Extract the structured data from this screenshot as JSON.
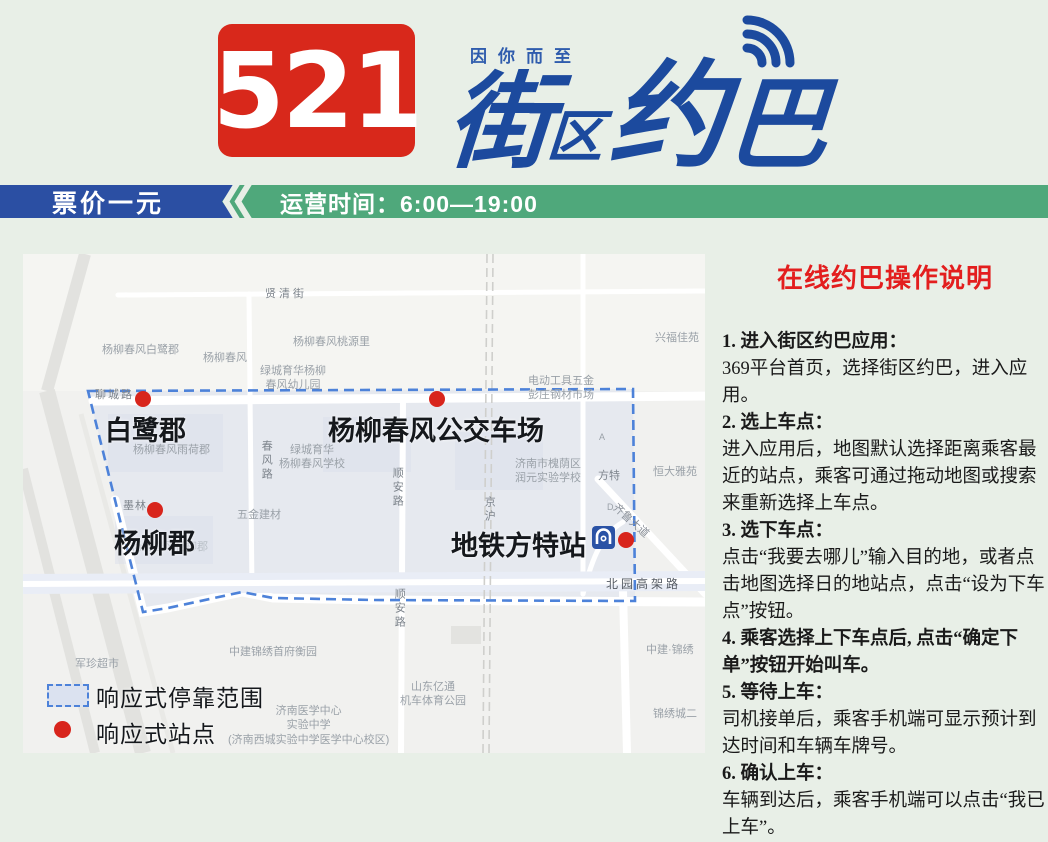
{
  "header": {
    "route_number": "521",
    "slogan": "因你而至",
    "brand_chars": {
      "c1": "街",
      "c2": "区",
      "c3": "约",
      "c4": "巴"
    },
    "colors": {
      "route_box": "#d8281b",
      "brand_blue": "#1c4a9e"
    }
  },
  "banner": {
    "fare": "票价一元",
    "hours": "运营时间：6:00—19:00",
    "colors": {
      "blue": "#2b4fa3",
      "green": "#4fa87b"
    }
  },
  "map": {
    "stations": [
      {
        "name": "白鹭郡",
        "dot_x": 120,
        "dot_y": 145,
        "label_x": 82,
        "label_y": 155
      },
      {
        "name": "杨柳春风公交车场",
        "dot_x": 414,
        "dot_y": 145,
        "label_x": 305,
        "label_y": 155
      },
      {
        "name": "杨柳郡",
        "dot_x": 132,
        "dot_y": 256,
        "label_x": 91,
        "label_y": 268
      },
      {
        "name": "地铁方特站",
        "dot_x": 603,
        "dot_y": 286,
        "label_x": 428,
        "label_y": 270
      }
    ],
    "legend": [
      {
        "label": "响应式停靠范围"
      },
      {
        "label": "响应式站点"
      }
    ],
    "labels": [
      {
        "t": "贤清街",
        "x": 242,
        "y": 33,
        "c": "#7d848c",
        "ls": 3
      },
      {
        "t": "杨柳春风白鹭郡",
        "x": 79,
        "y": 89
      },
      {
        "t": "杨柳春风",
        "x": 180,
        "y": 97
      },
      {
        "t": "杨柳春风桃源里",
        "x": 270,
        "y": 81
      },
      {
        "t": "绿城育华杨柳\n春风幼儿园",
        "x": 237,
        "y": 110,
        "ctr": true
      },
      {
        "t": "电动工具五金\n彭庄钢材市场",
        "x": 505,
        "y": 120,
        "ctr": true
      },
      {
        "t": "兴福佳苑",
        "x": 632,
        "y": 77
      },
      {
        "t": "聊城路",
        "x": 72,
        "y": 134,
        "c": "#7d848c",
        "ls": 2
      },
      {
        "t": "杨柳春风雨荷郡",
        "x": 110,
        "y": 189
      },
      {
        "t": "春风路",
        "x": 236,
        "y": 186,
        "c": "#7d848c",
        "v": true
      },
      {
        "t": "绿城育华\n杨柳春风学校",
        "x": 256,
        "y": 189,
        "ctr": true
      },
      {
        "t": "济南市槐荫区\n润元实验学校",
        "x": 492,
        "y": 203,
        "ctr": true
      },
      {
        "t": "方特",
        "x": 575,
        "y": 215,
        "c": "#7d848c"
      },
      {
        "t": "恒大雅苑",
        "x": 630,
        "y": 211
      },
      {
        "t": "顺安路",
        "x": 367,
        "y": 213,
        "c": "#7d848c",
        "v": true
      },
      {
        "t": "京沪",
        "x": 459,
        "y": 242,
        "c": "#7d848c",
        "v": true
      },
      {
        "t": "墨林",
        "x": 100,
        "y": 245,
        "c": "#7d848c",
        "ls": 1
      },
      {
        "t": "五金建材",
        "x": 214,
        "y": 254
      },
      {
        "t": "杨柳春风杨柳郡",
        "x": 108,
        "y": 286,
        "c": "#b8bfc6"
      },
      {
        "t": "齐鲁大道",
        "x": 596,
        "y": 247,
        "c": "#8a9099",
        "r": 42
      },
      {
        "t": "A",
        "x": 576,
        "y": 178,
        "s": 9
      },
      {
        "t": "D",
        "x": 584,
        "y": 248,
        "s": 9
      },
      {
        "t": "北园高架路",
        "x": 583,
        "y": 323,
        "c": "#555b63",
        "s": 12,
        "ls": 3
      },
      {
        "t": "顺安路",
        "x": 369,
        "y": 334,
        "c": "#7d848c",
        "v": true
      },
      {
        "t": "军珍超市",
        "x": 52,
        "y": 403
      },
      {
        "t": "中建锦绣首府衡园",
        "x": 206,
        "y": 391
      },
      {
        "t": "中建·锦绣",
        "x": 623,
        "y": 389
      },
      {
        "t": "山东亿通\n机车体育公园",
        "x": 377,
        "y": 426,
        "ctr": true
      },
      {
        "t": "锦绣城二",
        "x": 630,
        "y": 453
      },
      {
        "t": "济南医学中心\n实验中学\n(济南西城实验中学医学中心校区)",
        "x": 205,
        "y": 450,
        "ctr": true
      }
    ]
  },
  "instructions": {
    "title": "在线约巴操作说明",
    "steps": [
      {
        "heading": "1. 进入街区约巴应用：",
        "body": "369平台首页，选择街区约巴，进入应用。"
      },
      {
        "heading": "2. 选上车点：",
        "body": "进入应用后，地图默认选择距离乘客最近的站点，乘客可通过拖动地图或搜索来重新选择上车点。"
      },
      {
        "heading": "3. 选下车点：",
        "body": "点击“我要去哪儿”输入目的地，或者点击地图选择日的地站点，点击“设为下车点”按钮。"
      },
      {
        "heading": "4. 乘客选择上下车点后, 点击“确定下单”按钮开始叫车。",
        "body": ""
      },
      {
        "heading": "5. 等待上车：",
        "body": "司机接单后，乘客手机端可显示预计到达时间和车辆车牌号。"
      },
      {
        "heading": "6. 确认上车：",
        "body": "车辆到达后，乘客手机端可以点击“我已上车”。"
      }
    ]
  }
}
